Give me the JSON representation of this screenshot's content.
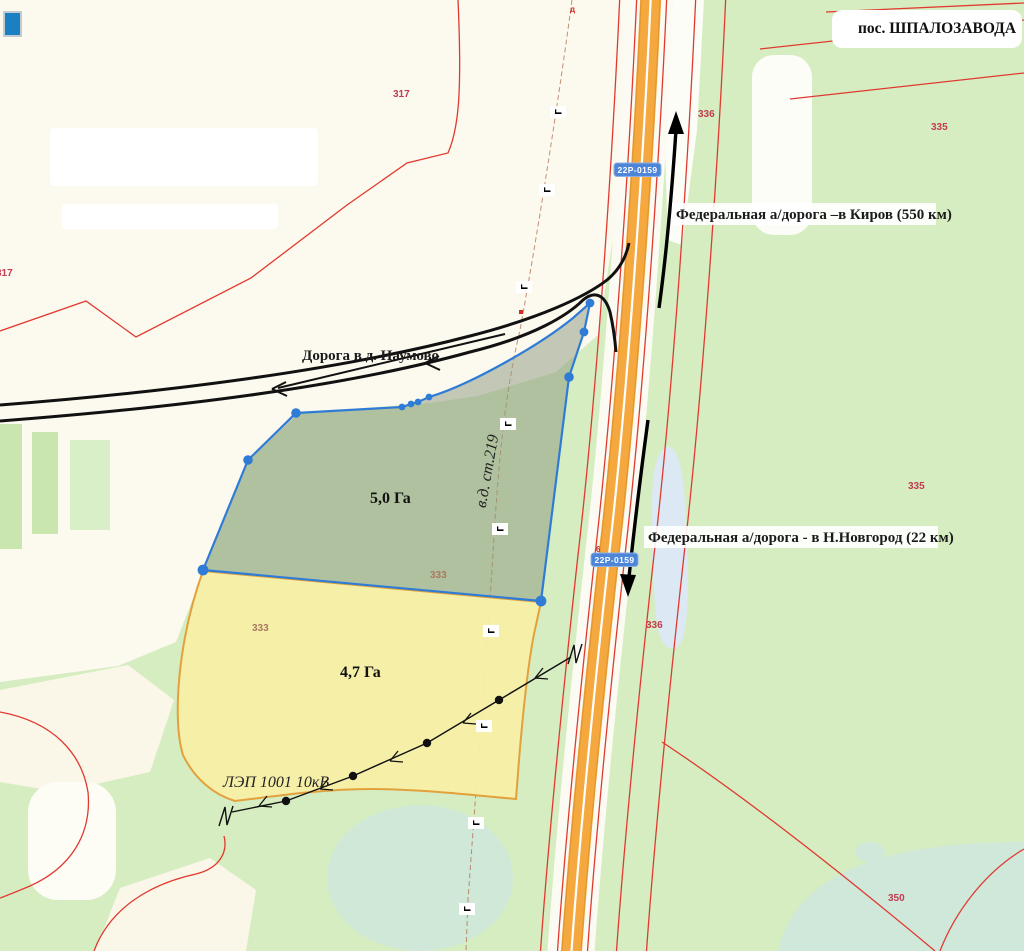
{
  "map": {
    "settlement": "пос. ШПАЛОЗАВОДА",
    "road_badge": "22Р-0159",
    "km_marker": "6",
    "top_marker": "д",
    "direction_kirov": "Федеральная а/дорога –в Киров (550 км)",
    "direction_novgorod": "Федеральная а/дорога - в Н.Новгород (22 км)",
    "local_road": "Дорога в д. Наумово",
    "plot_green_area": "5,0 Га",
    "plot_yellow_area": "4,7 Га",
    "power_line": "ЛЭП 1001 10кВ",
    "line_219": "в.д. ст.219",
    "pipeline_mark": "Г",
    "parcels": {
      "p317_top": "317",
      "p317_left": "317",
      "p336_top": "336",
      "p335_top": "335",
      "p335_mid": "335",
      "p336_mid": "336",
      "p333_upper": "333",
      "p333_lower": "333",
      "p350": "350"
    },
    "colors": {
      "base_green": "#d6edc1",
      "cream": "#fcf9ee",
      "highway_orange": "#f4a83e",
      "boundary_red": "#e03a30",
      "plot_outline_blue": "#2f7cd6",
      "plot_fill_grey": "#8e9a80",
      "plot_fill_yellow": "#f8efa6",
      "plot_outline_orange": "#e2a13c",
      "water": "#dce8f4",
      "lake": "#d0e8d8",
      "badge_blue": "#4d86d8"
    }
  }
}
